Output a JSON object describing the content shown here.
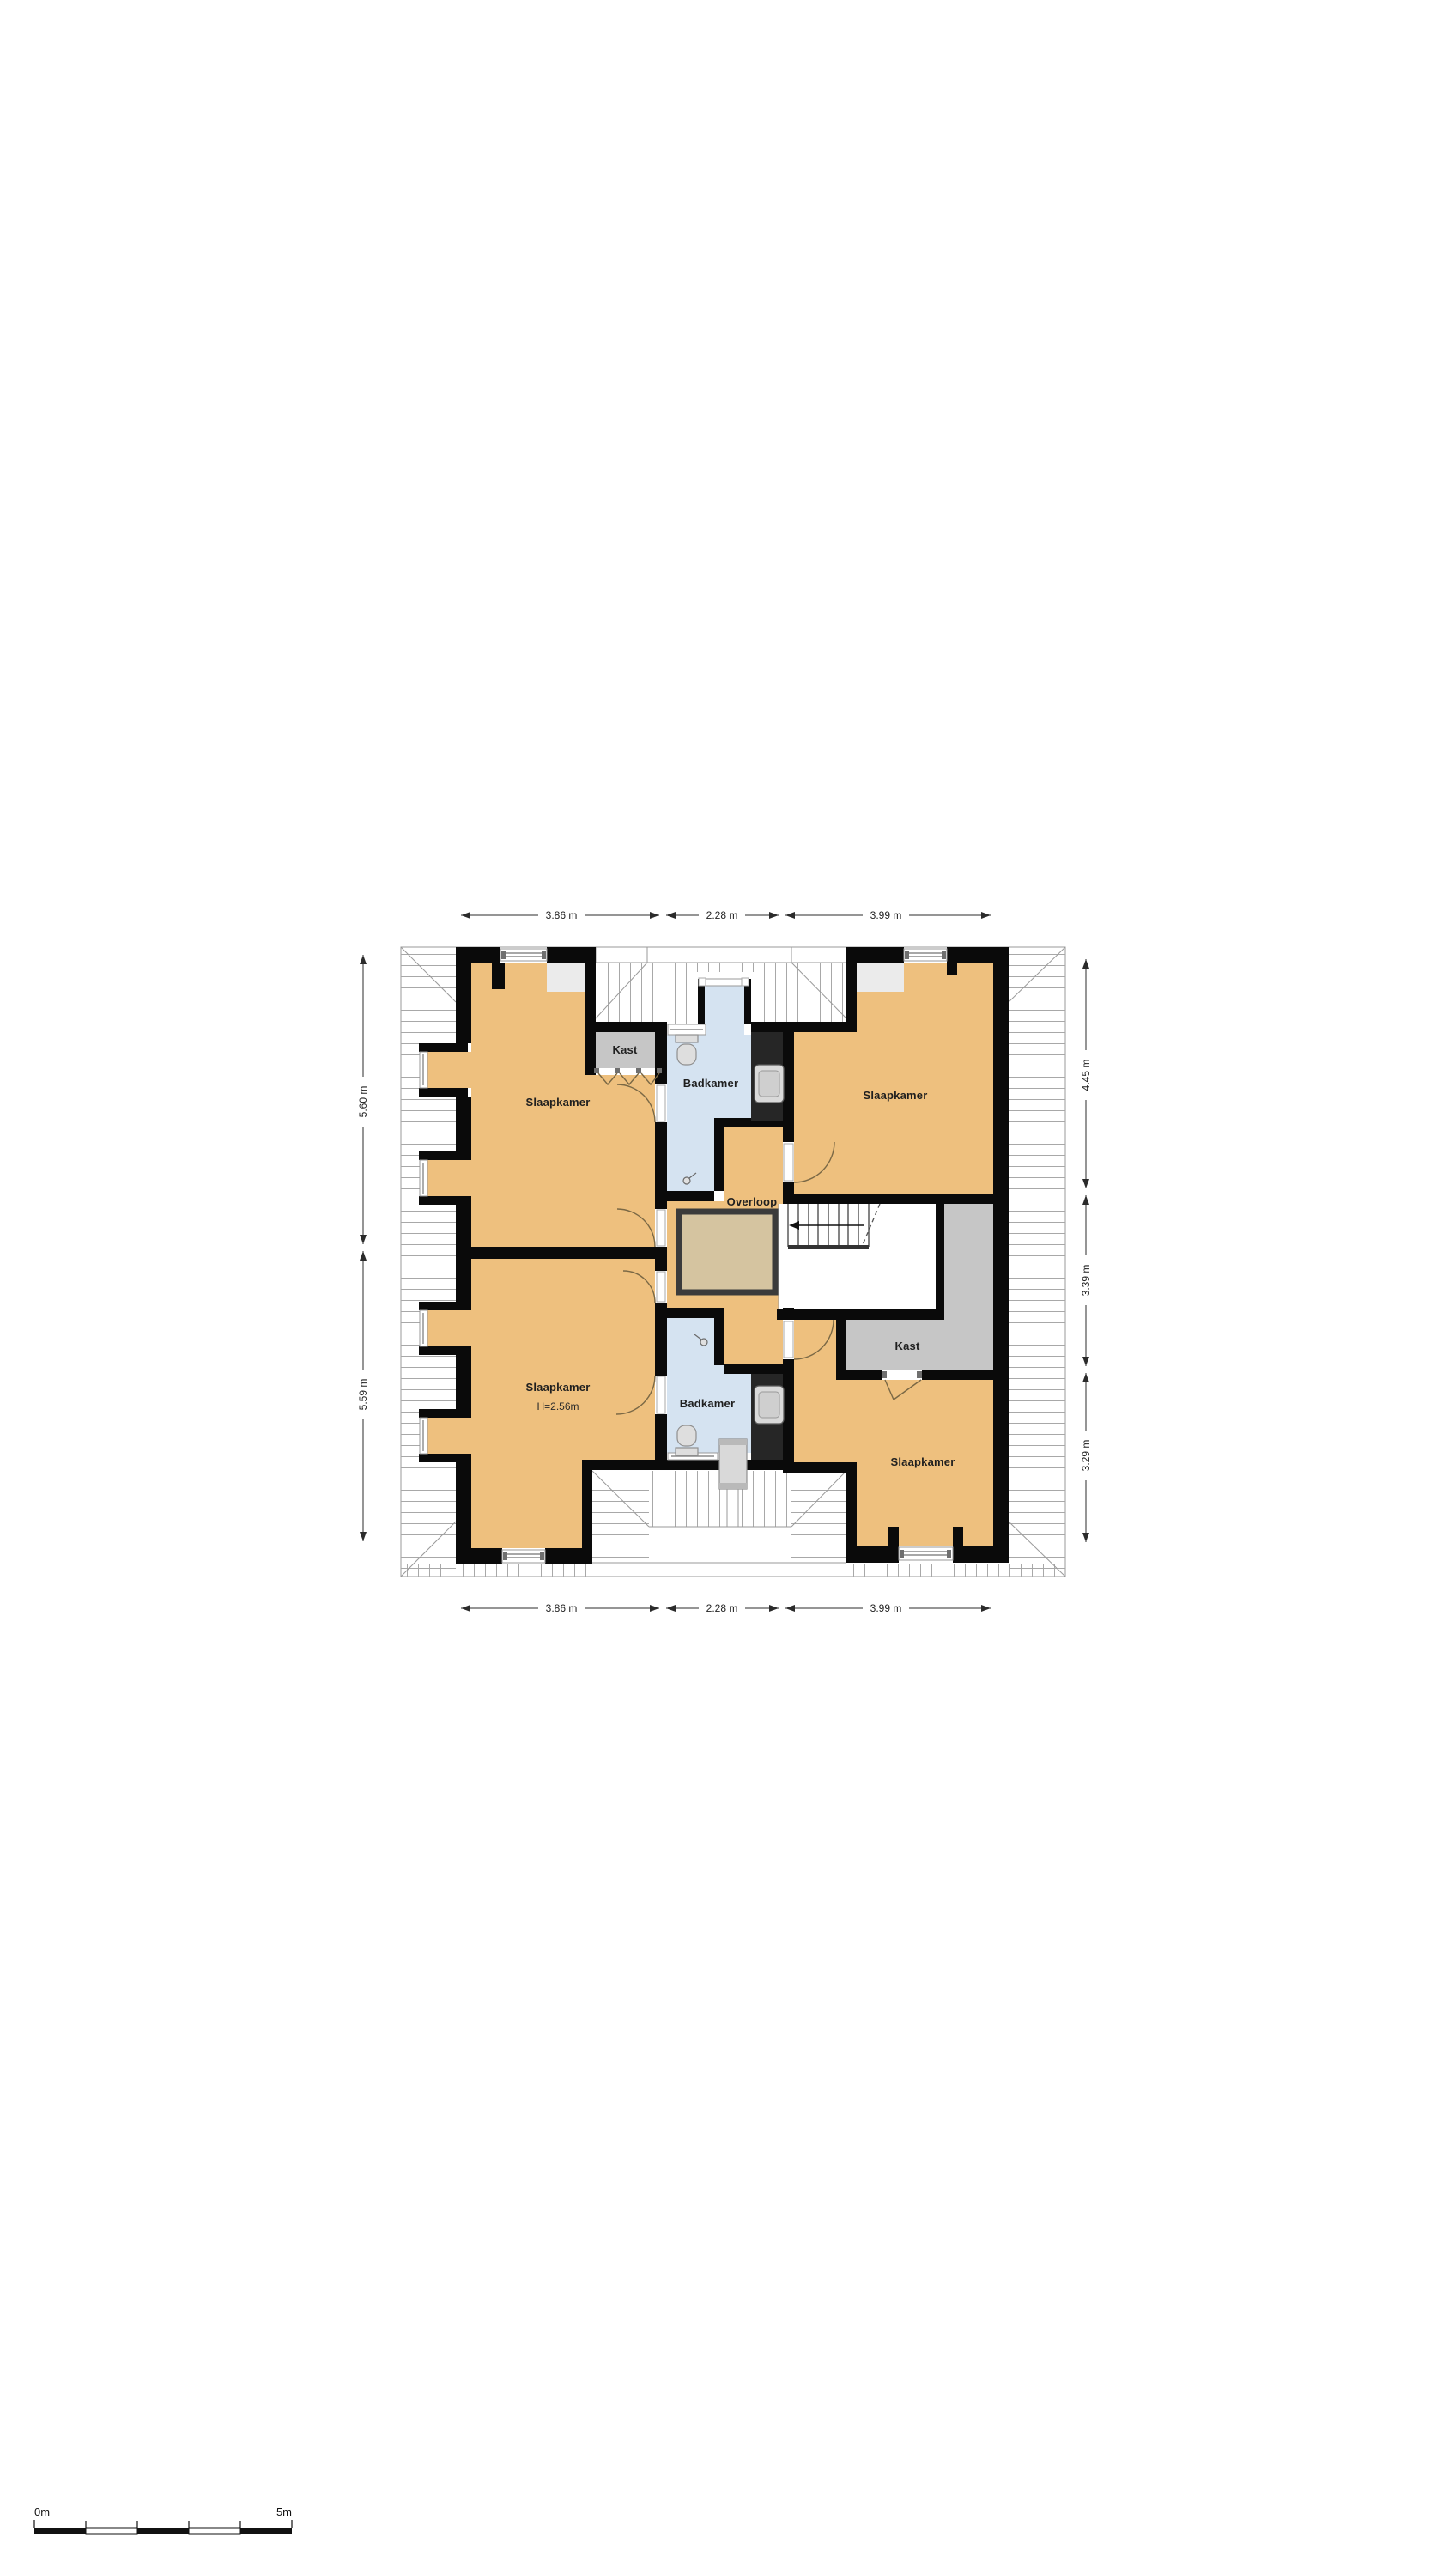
{
  "floor_plan": {
    "rooms": {
      "slaapkamer_top_left": {
        "label": "Slaapkamer"
      },
      "slaapkamer_top_right": {
        "label": "Slaapkamer"
      },
      "slaapkamer_bottom_left": {
        "label": "Slaapkamer",
        "height_note": "H=2.56m"
      },
      "slaapkamer_bottom_right": {
        "label": "Slaapkamer"
      },
      "badkamer_top": {
        "label": "Badkamer"
      },
      "badkamer_bottom": {
        "label": "Badkamer"
      },
      "kast_top": {
        "label": "Kast"
      },
      "kast_right": {
        "label": "Kast"
      },
      "overloop": {
        "label": "Overloop"
      }
    },
    "dimensions": {
      "top": [
        "3.86 m",
        "2.28 m",
        "3.99 m"
      ],
      "bottom": [
        "3.86 m",
        "2.28 m",
        "3.99 m"
      ],
      "left": [
        "5.60 m",
        "5.59 m"
      ],
      "right": [
        "4.45 m",
        "3.39 m",
        "3.29 m"
      ]
    },
    "colors": {
      "room_orange": "#eec07e",
      "bathroom_blue": "#d5e3f1",
      "closet_gray": "#c6c6c6",
      "duct_dark": "#262626",
      "wall_black": "#0a0a0a",
      "void_fill": "#d5c4a0",
      "void_border": "#3b3b3b",
      "ceiling_gray": "#ebebeb"
    }
  },
  "scale_bar": {
    "start_label": "0m",
    "end_label": "5m"
  }
}
